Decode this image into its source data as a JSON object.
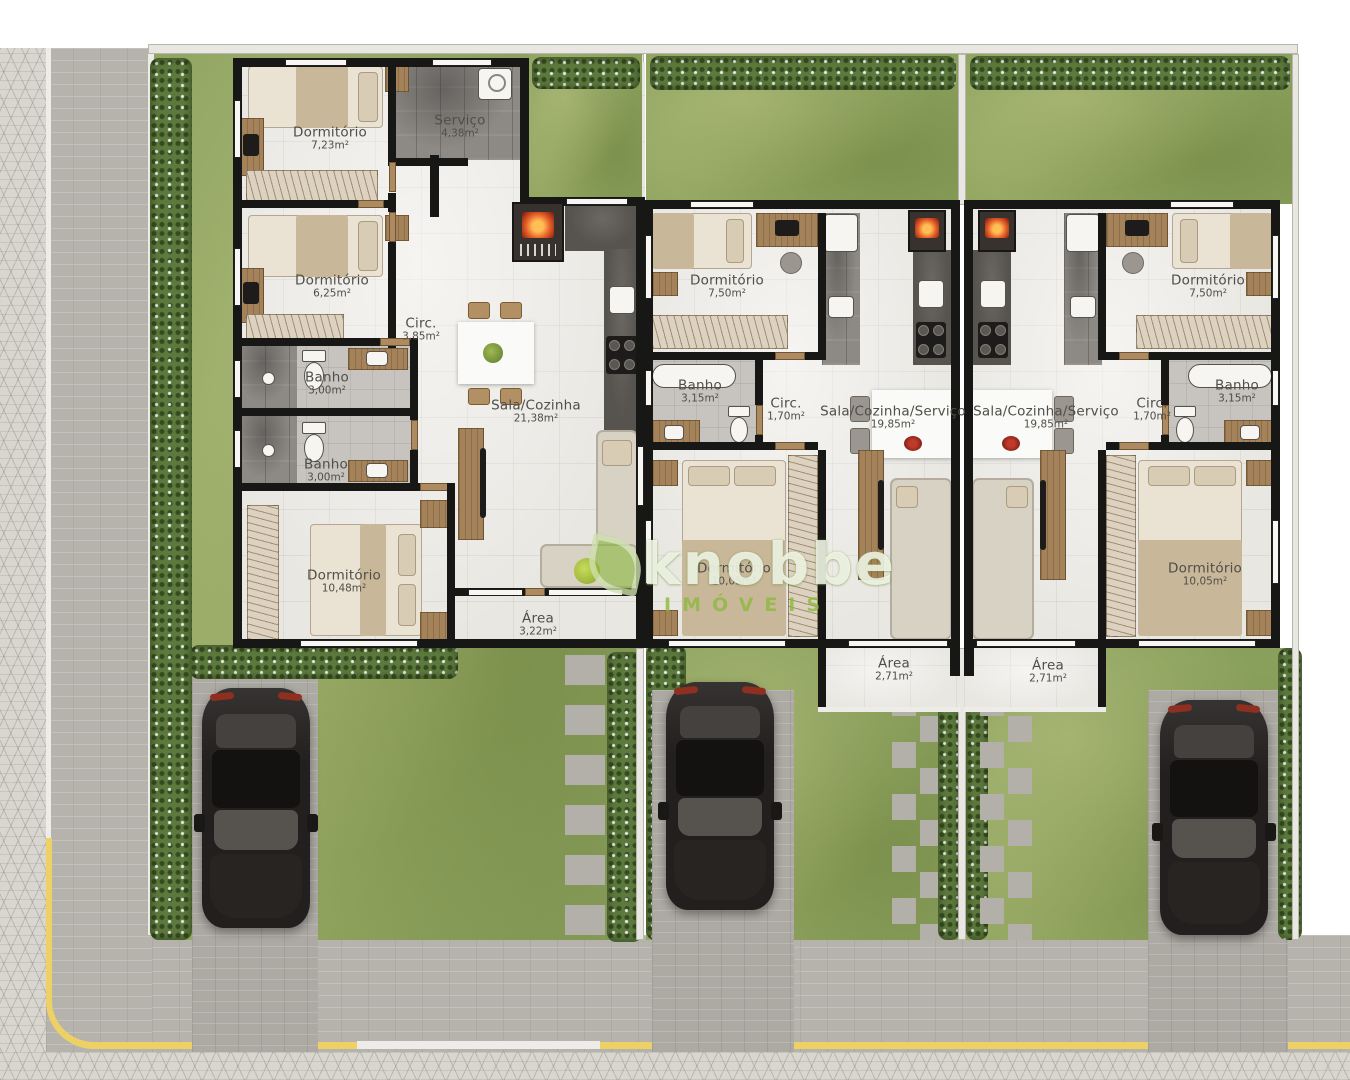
{
  "plan": {
    "watermark": {
      "brand": "knobbe",
      "subtitle": "IMÓVEIS"
    },
    "colors": {
      "grass": "#89a05c",
      "hedge": "#5d7a3e",
      "road": "#b6b3ad",
      "sidewalk": "#d9d6d0",
      "wall": "#171715",
      "floor": "#e9e7e2",
      "curb_yellow": "#eed164",
      "watermark_green": "#8eba3e",
      "label_text": "#504e48"
    },
    "houses": [
      {
        "name": "house-1",
        "rooms": [
          {
            "name": "Dormitório",
            "area": "7,23m²"
          },
          {
            "name": "Serviço",
            "area": "4,38m²"
          },
          {
            "name": "Dormitório",
            "area": "6,25m²"
          },
          {
            "name": "Circ.",
            "area": "3,85m²"
          },
          {
            "name": "Banho",
            "area": "3,00m²"
          },
          {
            "name": "Banho",
            "area": "3,00m²"
          },
          {
            "name": "Sala/Cozinha",
            "area": "21,38m²"
          },
          {
            "name": "Dormitório",
            "area": "10,48m²"
          },
          {
            "name": "Área",
            "area": "3,22m²"
          }
        ]
      },
      {
        "name": "house-2",
        "rooms": [
          {
            "name": "Dormitório",
            "area": "7,50m²"
          },
          {
            "name": "Banho",
            "area": "3,15m²"
          },
          {
            "name": "Circ.",
            "area": "1,70m²"
          },
          {
            "name": "Sala/Cozinha/Serviço",
            "area": "19,85m²"
          },
          {
            "name": "Dormitório",
            "area": "10,05m²"
          },
          {
            "name": "Área",
            "area": "2,71m²"
          }
        ]
      },
      {
        "name": "house-3",
        "rooms": [
          {
            "name": "Dormitório",
            "area": "7,50m²"
          },
          {
            "name": "Banho",
            "area": "3,15m²"
          },
          {
            "name": "Circ.",
            "area": "1,70m²"
          },
          {
            "name": "Sala/Cozinha/Serviço",
            "area": "19,85m²"
          },
          {
            "name": "Dormitório",
            "area": "10,05m²"
          },
          {
            "name": "Área",
            "area": "2,71m²"
          }
        ]
      }
    ]
  }
}
